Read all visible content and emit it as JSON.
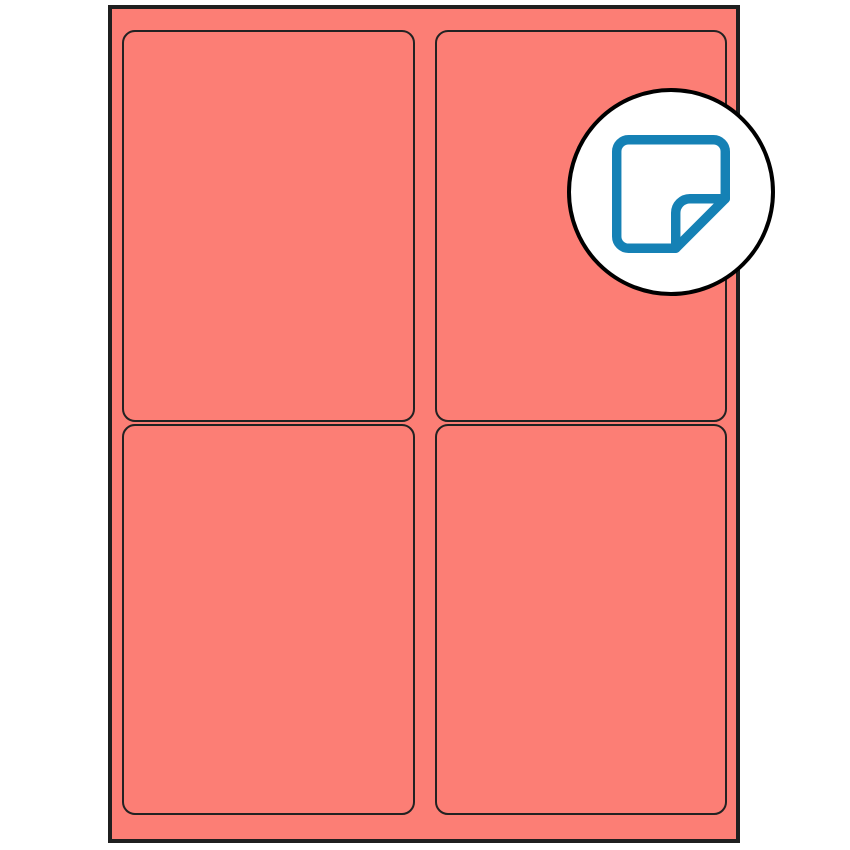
{
  "page": {
    "background": "#FFFFFF"
  },
  "sheet": {
    "description": "Blank label sheet with 4 rounded-rectangle labels in a 2x2 grid",
    "fill_color": "#FC7E75",
    "outline_color": "#1F1F1F",
    "label_outline_color": "#222222",
    "columns": 2,
    "rows": 2,
    "label_count": 4,
    "labels": [
      {
        "row": 1,
        "col": 1
      },
      {
        "row": 1,
        "col": 2
      },
      {
        "row": 2,
        "col": 1
      },
      {
        "row": 2,
        "col": 2
      }
    ]
  },
  "badge": {
    "shape": "circle",
    "fill_color": "#FFFFFF",
    "outline_color": "#000000",
    "icon": "sticker-icon",
    "icon_color": "#1581B5"
  }
}
